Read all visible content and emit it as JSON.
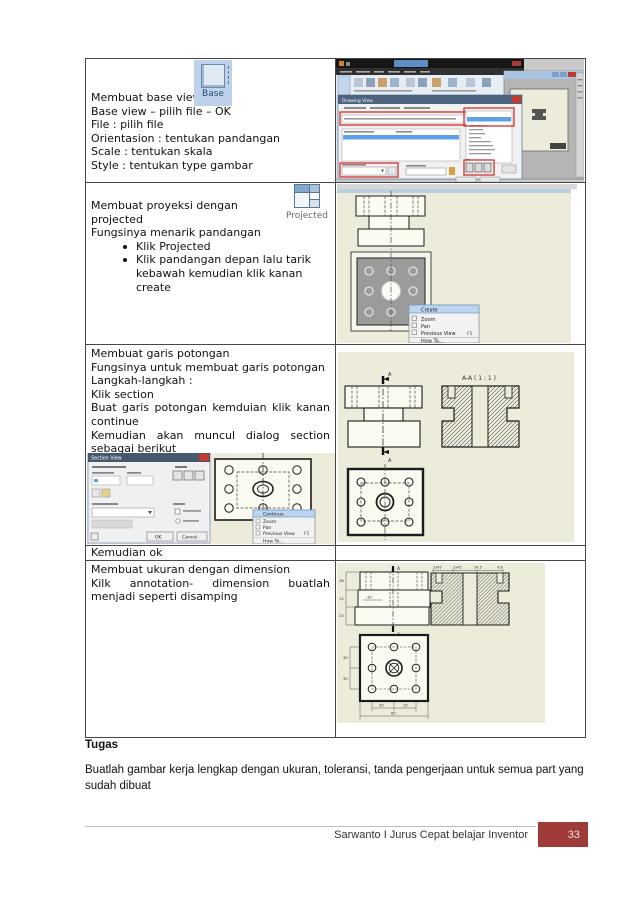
{
  "row_base": {
    "icon_label": "Base",
    "line1": "Membuat base view",
    "line2": "Base view – pilih file – OK",
    "line3": "File : pilih file",
    "line4": "Orientasion : tentukan pandangan",
    "line5": "Scale : tentukan skala",
    "line6": "Style : tentukan type gambar"
  },
  "row_projected": {
    "icon_label": "Projected",
    "line1": "Membuat proyeksi dengan projected",
    "line2": "Fungsinya menarik pandangan",
    "bullet1": "Klik Projected",
    "bullet2": "Klik pandangan depan lalu tarik kebawah kemudian klik kanan create"
  },
  "row_section": {
    "line1": "Membuat garis potongan",
    "line2": "Fungsinya untuk membuat garis potongan",
    "line3": "Langkah-langkah :",
    "line4": "Klik section",
    "line5": "Buat garis potongan kemduian klik kanan continue",
    "line6": "Kemudian akan muncul dialog section sebagai berikut"
  },
  "row_ok": {
    "text": "Kemudian ok"
  },
  "row_dimension": {
    "line1": "Membuat ukuran dengan dimension",
    "line2": "Kilk annotation- dimension buatlah menjadi seperti disamping"
  },
  "drawing_view_dialog": {
    "title": "Drawing View"
  },
  "section_dialog": {
    "title": "Section View",
    "ok": "OK",
    "cancel": "Cancel"
  },
  "menu_create": {
    "item1": "Create",
    "item2": "Zoom",
    "item3": "Pan",
    "item4": "Previous View",
    "shortcut": "F5",
    "item5": "How To..."
  },
  "menu_continue": {
    "item1": "Continue",
    "item2": "Zoom",
    "item3": "Pan",
    "item4": "Previous View",
    "shortcut": "F5",
    "item5": "How To..."
  },
  "section_view_label": {
    "text": "A-A ( 1 : 1 )",
    "marker": "A"
  },
  "dims": {
    "marker": "A",
    "front_left": [
      "38",
      "12",
      "25"
    ],
    "front_inner": "30",
    "section_top": [
      "2x45",
      "2x45",
      "24.5",
      "4.8"
    ],
    "top_left": [
      "30",
      "30"
    ],
    "top_bottom": [
      "30",
      "15"
    ],
    "top_overall": "60"
  },
  "tugas": {
    "heading": "Tugas",
    "body": "Buatlah gambar kerja lengkap dengan ukuran, toleransi, tanda pengerjaan untuk semua part yang sudah dibuat"
  },
  "footer": {
    "text": "Sarwanto I Jurus Cepat belajar Inventor",
    "page": "33",
    "accent_color": "#9e3a38",
    "canvas_color": "#edecda"
  }
}
